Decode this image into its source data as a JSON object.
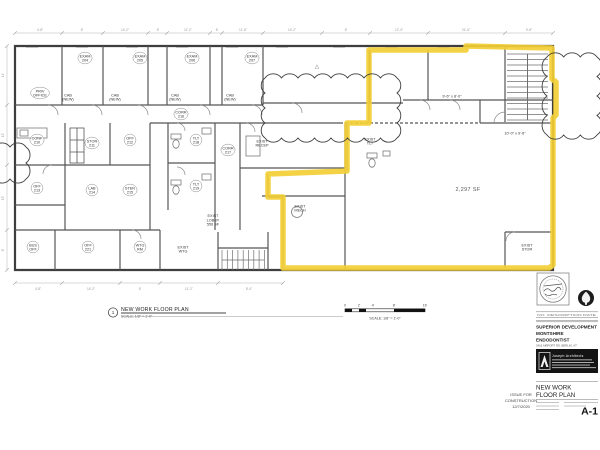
{
  "colors": {
    "highlight": "#f2cf35",
    "wall": "#4a4a4a",
    "dim_gray": "#979797"
  },
  "plan": {
    "area_label": "2,297 SF",
    "triangle_marker": "△",
    "rooms": [
      {
        "x": 40,
        "y": 93,
        "lines": [
          "PRIV",
          "OFFICE"
        ],
        "oval": true
      },
      {
        "x": 85,
        "y": 58,
        "lines": [
          "EXAM",
          "204"
        ],
        "oval": true
      },
      {
        "x": 140,
        "y": 58,
        "lines": [
          "EXAM",
          "205"
        ],
        "oval": true
      },
      {
        "x": 192,
        "y": 58,
        "lines": [
          "EXAM",
          "206"
        ],
        "oval": true
      },
      {
        "x": 252,
        "y": 58,
        "lines": [
          "EXAM",
          "207"
        ],
        "oval": true
      },
      {
        "x": 68,
        "y": 97,
        "lines": [
          "CAB",
          "(NEW)"
        ]
      },
      {
        "x": 115,
        "y": 97,
        "lines": [
          "CAB",
          "(NEW)"
        ]
      },
      {
        "x": 175,
        "y": 97,
        "lines": [
          "CAB",
          "(NEW)"
        ]
      },
      {
        "x": 230,
        "y": 97,
        "lines": [
          "CAB",
          "(NEW)"
        ]
      },
      {
        "x": 181,
        "y": 114,
        "lines": [
          "CORR",
          "216"
        ],
        "oval": true
      },
      {
        "x": 228,
        "y": 150,
        "lines": [
          "CORR",
          "217"
        ],
        "oval": true
      },
      {
        "x": 37,
        "y": 140,
        "lines": [
          "CONF",
          "210"
        ],
        "oval": true
      },
      {
        "x": 92,
        "y": 143,
        "lines": [
          "STOR",
          "211"
        ],
        "oval": true
      },
      {
        "x": 130,
        "y": 140,
        "lines": [
          "OFF",
          "212"
        ],
        "oval": true
      },
      {
        "x": 37,
        "y": 188,
        "lines": [
          "OFF",
          "213"
        ],
        "oval": true
      },
      {
        "x": 92,
        "y": 190,
        "lines": [
          "LAB",
          "214"
        ],
        "oval": true
      },
      {
        "x": 130,
        "y": 190,
        "lines": [
          "STER",
          "215"
        ],
        "oval": true
      },
      {
        "x": 196,
        "y": 140,
        "lines": [
          "TLT",
          "218"
        ],
        "oval": true
      },
      {
        "x": 196,
        "y": 186,
        "lines": [
          "TLT",
          "219"
        ],
        "oval": true
      },
      {
        "x": 262,
        "y": 143,
        "lines": [
          "EXIST",
          "RECEP"
        ]
      },
      {
        "x": 300,
        "y": 208,
        "lines": [
          "EXIST",
          "MECH"
        ]
      },
      {
        "x": 370,
        "y": 141,
        "lines": [
          "EXIST",
          "TLT"
        ]
      },
      {
        "x": 213,
        "y": 220,
        "lines": [
          "EXIST",
          "LOBBY",
          "556 SF"
        ]
      },
      {
        "x": 33,
        "y": 247,
        "lines": [
          "BUS",
          "OFF"
        ],
        "oval": true
      },
      {
        "x": 88,
        "y": 247,
        "lines": [
          "OFF",
          "221"
        ],
        "oval": true
      },
      {
        "x": 140,
        "y": 247,
        "lines": [
          "WTG",
          "RM"
        ],
        "oval": true
      },
      {
        "x": 183,
        "y": 249,
        "lines": [
          "EXIST",
          "WTG"
        ]
      },
      {
        "x": 452,
        "y": 96,
        "lines": [
          "9'-6\" x 8'-0\""
        ]
      },
      {
        "x": 515,
        "y": 133,
        "lines": [
          "10'-0\" x 9'-6\""
        ]
      },
      {
        "x": 527,
        "y": 247,
        "lines": [
          "EXIST",
          "STOR"
        ]
      }
    ],
    "dims_top": [
      {
        "x": 40,
        "t": "4'-8\""
      },
      {
        "x": 82,
        "t": "8'"
      },
      {
        "x": 125,
        "t": "14'-2\""
      },
      {
        "x": 158,
        "t": "8'"
      },
      {
        "x": 188,
        "t": "11'-2\""
      },
      {
        "x": 217,
        "t": "8'"
      },
      {
        "x": 243,
        "t": "11'-6\""
      },
      {
        "x": 292,
        "t": "14'-2\""
      },
      {
        "x": 346,
        "t": "8'"
      },
      {
        "x": 399,
        "t": "12'-4\""
      },
      {
        "x": 466,
        "t": "21'-6\""
      },
      {
        "x": 529,
        "t": "9'-8\""
      }
    ],
    "dims_bottom": [
      {
        "x": 38,
        "t": "4'-8\""
      },
      {
        "x": 91,
        "t": "14'-2\""
      },
      {
        "x": 140,
        "t": "8'"
      },
      {
        "x": 189,
        "t": "11'-2\""
      },
      {
        "x": 249,
        "t": "8'-4\""
      }
    ],
    "dims_left": [
      {
        "y": 75,
        "t": "14'"
      },
      {
        "y": 135,
        "t": "12'"
      },
      {
        "y": 198,
        "t": "13'"
      },
      {
        "y": 250,
        "t": "8'"
      }
    ]
  },
  "callout": {
    "number": "1",
    "title": "NEW WORK FLOOR PLAN",
    "scale": "SCALE: 1/8\" = 1'-0\""
  },
  "scale_bar": {
    "ticks": [
      "0",
      "2'",
      "4'",
      "8'",
      "16'"
    ],
    "label": "SCALE: 1/8\" = 1'-0\""
  },
  "title_block": {
    "revision_header": "NO.   DESCRIPTION   DATE",
    "project_line1": "SUPERIOR DEVELOPMENT",
    "project_line2": "MONTSHIRE",
    "project_line3": "ENDODONTIST",
    "address": "2416 AIRPORT RD, BERLIN, VT",
    "architect": "Joseph Architects",
    "sheet_title_line1": "NEW WORK",
    "sheet_title_line2": "FLOOR PLAN",
    "sheet_number": "A-1",
    "issue_line1": "ISSUE FOR",
    "issue_line2": "CONSTRUCTION",
    "issue_date": "12/7/2020"
  }
}
